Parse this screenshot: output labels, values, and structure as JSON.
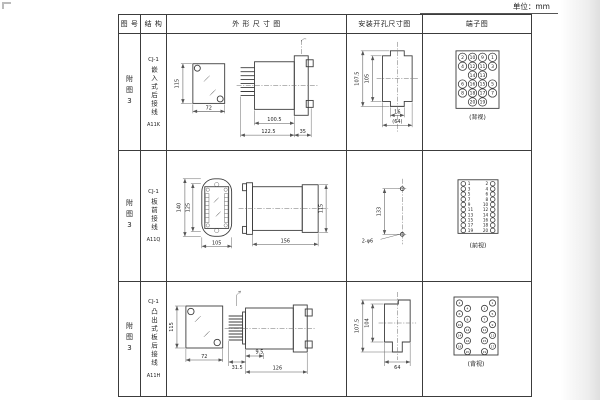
{
  "page": {
    "unit_label": "单位：mm"
  },
  "table": {
    "headers": {
      "fig_no": "图 号",
      "structure": "结 构",
      "outline": "外 形 尺 寸 图",
      "mounting": "安装开孔尺寸图",
      "terminal": "端子图"
    },
    "rows": [
      {
        "fig_no": "附图3",
        "model": "CJ-1",
        "structure": "嵌入式后接线",
        "code": "A11K",
        "outline_dims": {
          "h": "115",
          "w": "72",
          "a": "100.5",
          "b": "122.5",
          "c": "35"
        },
        "mount_dims": {
          "a": "107.5",
          "b": "105",
          "c": "16",
          "d": "(64)"
        },
        "terminal": {
          "view": "(背视)",
          "grid": [
            [
              "2",
              "10",
              "9",
              "1"
            ],
            [
              "4",
              "12",
              "11",
              "3"
            ],
            [
              "",
              "14",
              "13",
              ""
            ],
            [
              "6",
              "16",
              "15",
              "5"
            ],
            [
              "8",
              "18",
              "17",
              "7"
            ],
            [
              "",
              "20",
              "19",
              ""
            ]
          ]
        }
      },
      {
        "fig_no": "附图3",
        "model": "CJ-1",
        "structure": "板前接线",
        "code": "A11Q",
        "outline_dims": {
          "a": "140",
          "b": "125",
          "c": "105",
          "d": "156",
          "e": "115"
        },
        "mount_dims": {
          "a": "133",
          "b": "2-φ6"
        },
        "terminal": {
          "view": "(前视)",
          "left": [
            "1",
            "3",
            "5",
            "7",
            "9",
            "11",
            "13",
            "15",
            "17",
            "19"
          ],
          "right": [
            "2",
            "4",
            "6",
            "8",
            "10",
            "12",
            "14",
            "16",
            "18",
            "20"
          ]
        }
      },
      {
        "fig_no": "附图3",
        "model": "CJ-1",
        "structure": "凸出式板后接线",
        "code": "A11H",
        "outline_dims": {
          "h": "115",
          "w": "72",
          "a": "31.5",
          "b": "9.5",
          "c": "126"
        },
        "mount_dims": {
          "a": "107.5",
          "b": "104",
          "c": "64"
        },
        "terminal": {
          "view": "(背视)",
          "cols": {
            "left_outer": [
              "2",
              "6",
              "10",
              "14",
              "18"
            ],
            "left_inner": [
              "4",
              "8",
              "12",
              "16",
              "20"
            ],
            "right_inner": [
              "3",
              "7",
              "11",
              "15",
              "19"
            ],
            "right_outer": [
              "1",
              "5",
              "9",
              "13",
              "17"
            ]
          }
        }
      }
    ]
  }
}
